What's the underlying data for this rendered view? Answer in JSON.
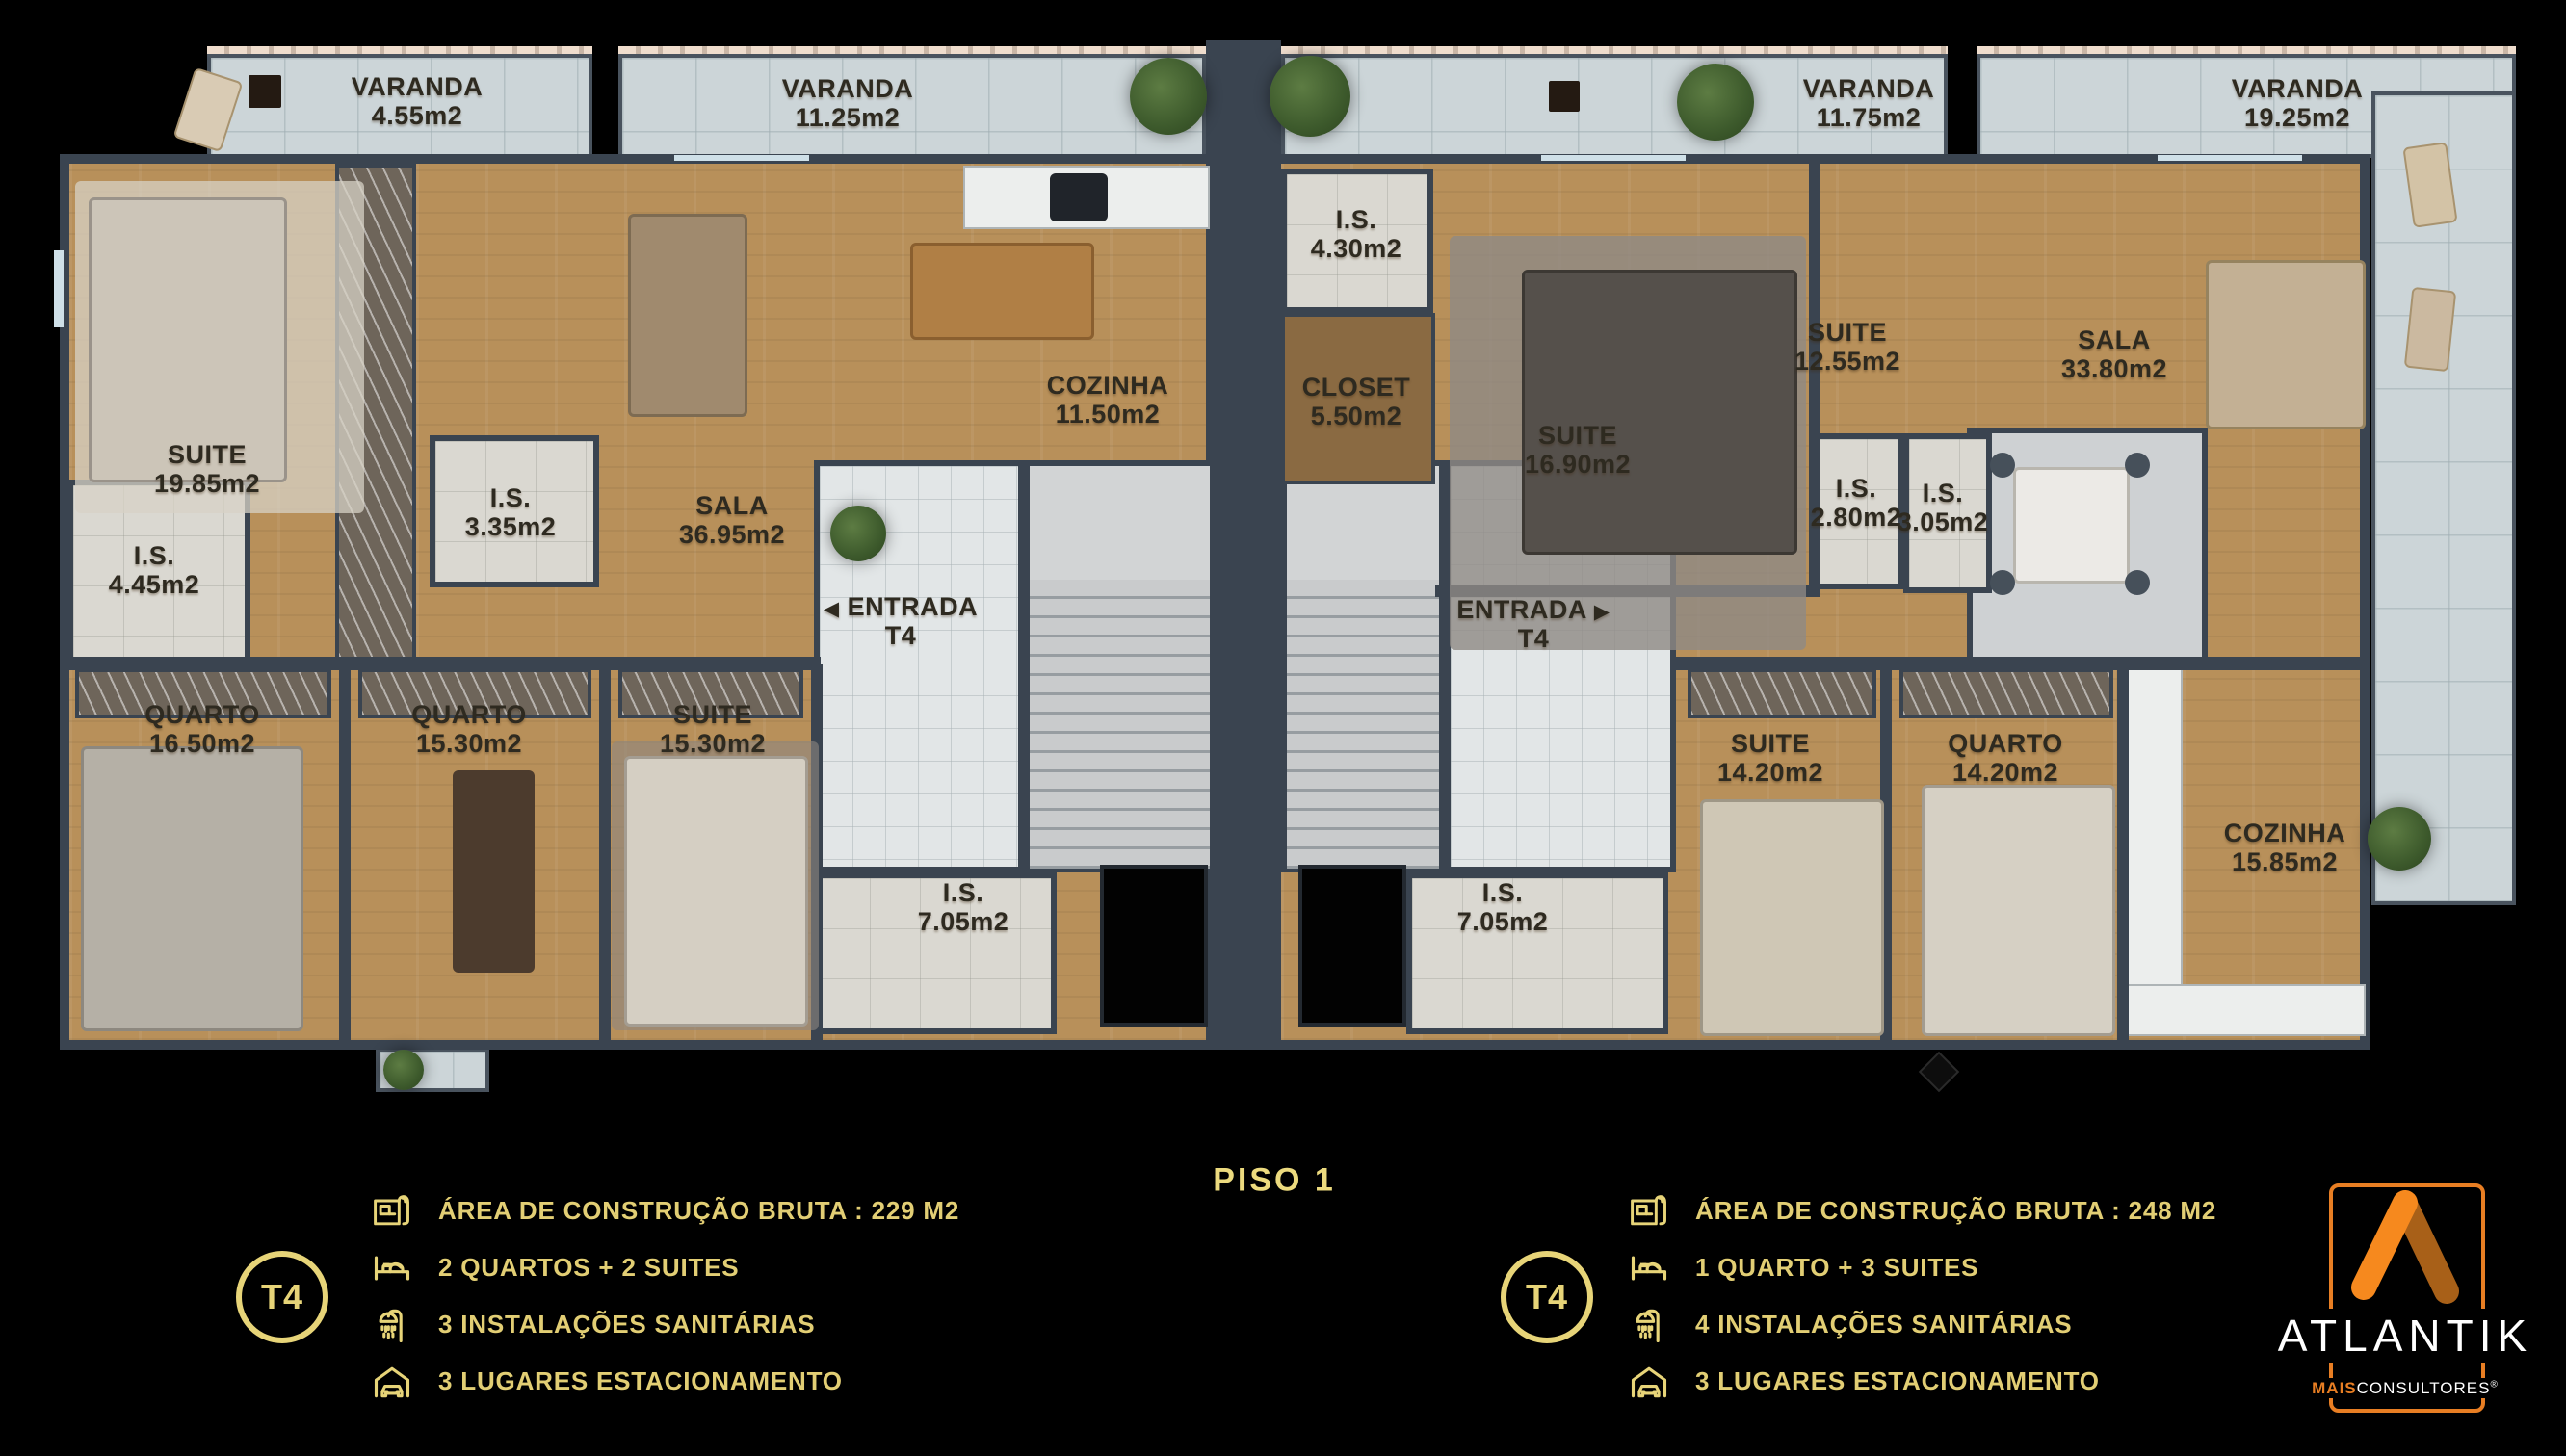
{
  "plan": {
    "floor_label": "PISO 1",
    "rooms": [
      {
        "name": "VARANDA",
        "area": "4.55m2"
      },
      {
        "name": "VARANDA",
        "area": "11.25m2"
      },
      {
        "name": "VARANDA",
        "area": "11.75m2"
      },
      {
        "name": "VARANDA",
        "area": "19.25m2"
      },
      {
        "name": "SUITE",
        "area": "19.85m2"
      },
      {
        "name": "I.S.",
        "area": "4.45m2"
      },
      {
        "name": "I.S.",
        "area": "3.35m2"
      },
      {
        "name": "SALA",
        "area": "36.95m2"
      },
      {
        "name": "COZINHA",
        "area": "11.50m2"
      },
      {
        "name": "ENTRADA",
        "area": "T4",
        "arrow": "◀"
      },
      {
        "name": "QUARTO",
        "area": "16.50m2"
      },
      {
        "name": "QUARTO",
        "area": "15.30m2"
      },
      {
        "name": "SUITE",
        "area": "15.30m2"
      },
      {
        "name": "I.S.",
        "area": "7.05m2"
      },
      {
        "name": "I.S.",
        "area": "4.30m2"
      },
      {
        "name": "CLOSET",
        "area": "5.50m2"
      },
      {
        "name": "SUITE",
        "area": "16.90m2"
      },
      {
        "name": "SUITE",
        "area": "12.55m2"
      },
      {
        "name": "I.S.",
        "area": "2.80m2"
      },
      {
        "name": "I.S.",
        "area": "3.05m2"
      },
      {
        "name": "SALA",
        "area": "33.80m2"
      },
      {
        "name": "ENTRADA",
        "area": "T4",
        "arrow": "▶"
      },
      {
        "name": "SUITE",
        "area": "14.20m2"
      },
      {
        "name": "QUARTO",
        "area": "14.20m2"
      },
      {
        "name": "COZINHA",
        "area": "15.85m2"
      },
      {
        "name": "I.S.",
        "area": "7.05m2"
      }
    ]
  },
  "legend": {
    "left": {
      "badge": "T4",
      "items": [
        {
          "icon": "blueprint-icon",
          "label": "ÁREA DE CONSTRUÇÃO BRUTA :  229 M2"
        },
        {
          "icon": "bed-icon",
          "label": "2 QUARTOS + 2 SUITES"
        },
        {
          "icon": "shower-icon",
          "label": "3 INSTALAÇÕES SANITÁRIAS"
        },
        {
          "icon": "garage-icon",
          "label": "3 LUGARES ESTACIONAMENTO"
        }
      ]
    },
    "right": {
      "badge": "T4",
      "items": [
        {
          "icon": "blueprint-icon",
          "label": "ÁREA DE CONSTRUÇÃO BRUTA :  248 M2"
        },
        {
          "icon": "bed-icon",
          "label": "1 QUARTO + 3 SUITES"
        },
        {
          "icon": "shower-icon",
          "label": "4 INSTALAÇÕES SANITÁRIAS"
        },
        {
          "icon": "garage-icon",
          "label": "3 LUGARES ESTACIONAMENTO"
        }
      ]
    }
  },
  "brand": {
    "name": "ATLANTIK",
    "tagline_bold": "MAIS",
    "tagline": "CONSULTORES",
    "registered": "®",
    "accent": "#E87E23",
    "accent_dark": "#A86018",
    "gold": "#E7D478"
  }
}
